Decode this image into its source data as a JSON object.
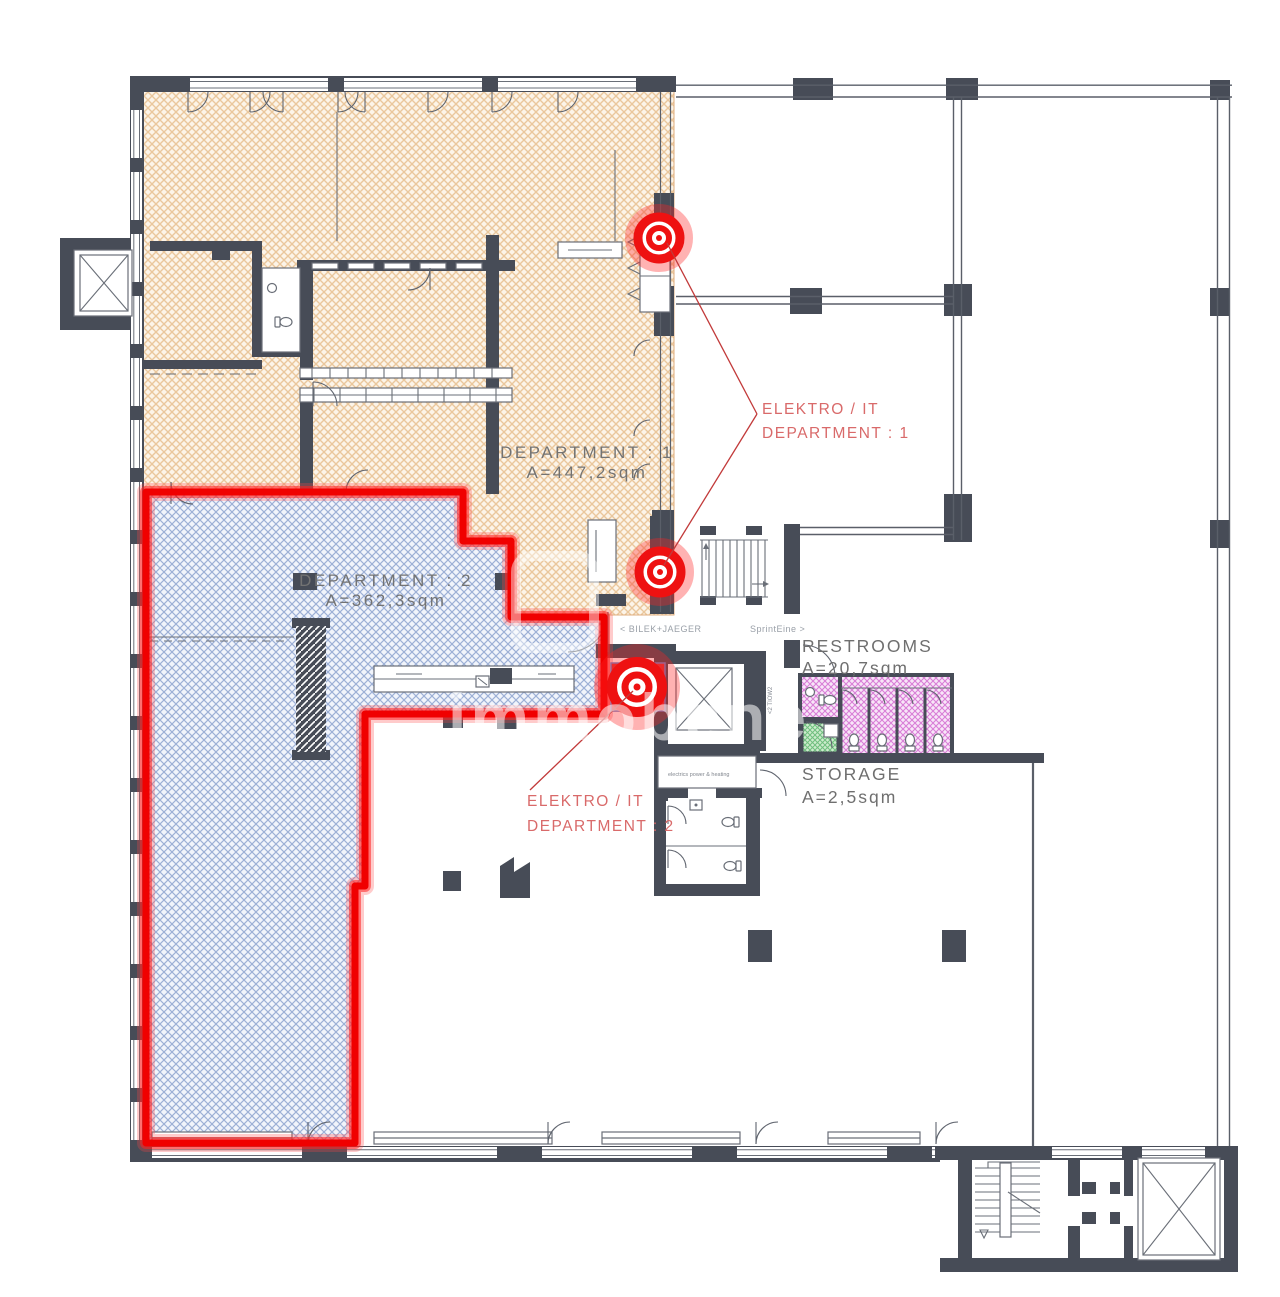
{
  "plan": {
    "title_labels": {
      "department1": {
        "name": "DEPARTMENT : 1",
        "area": "A=447,2sqm"
      },
      "department2": {
        "name": "DEPARTMENT : 2",
        "area": "A=362,3sqm"
      },
      "restrooms": {
        "name": "RESTROOMS",
        "area": "A=20,7sqm"
      },
      "storage": {
        "name": "STORAGE",
        "area": "A=2,5sqm"
      }
    },
    "annotations": {
      "elektro1": {
        "line1": "ELEKTRO / IT",
        "line2": "DEPARTMENT : 1"
      },
      "elektro2": {
        "line1": "ELEKTRO / IT",
        "line2": "DEPARTMENT : 2"
      }
    },
    "corridor": {
      "left": "< BILEK+JAEGER",
      "right": "SprintEine >",
      "vertical": "<2 TIOW2"
    },
    "rooms_small": {
      "utility": "electrics power & heating"
    },
    "watermark": "immobene",
    "colors": {
      "wall": "#474c57",
      "dept1_fill": "#fcf4e8",
      "dept1_hatch": "#eac79c",
      "dept2_fill": "#f1f4fb",
      "dept2_hatch": "#9db0d6",
      "highlight_red": "#ff1605",
      "restroom_fill": "#f8e6f8",
      "restroom_hatch": "#d97ed7",
      "storage_fill": "#cdeccd",
      "storage_hatch": "#6fbf7e",
      "label_gray": "#737373",
      "label_red": "#d96a6a"
    }
  }
}
